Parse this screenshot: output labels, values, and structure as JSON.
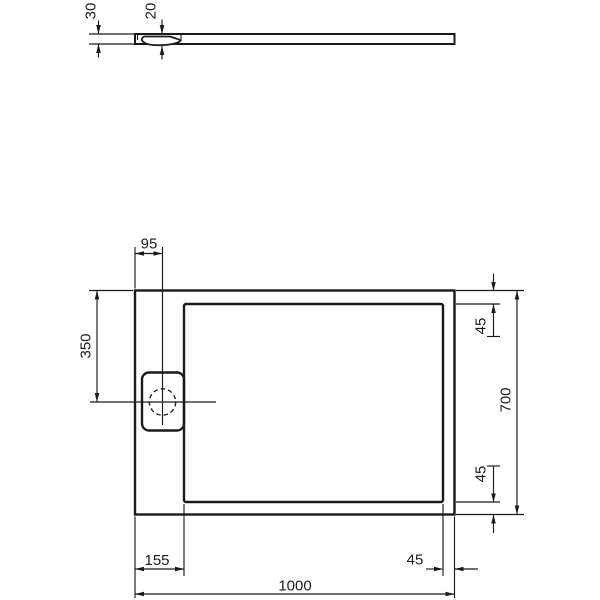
{
  "drawing": {
    "kind": "shower-tray dimension drawing",
    "colors": {
      "line": "#1a1a1a",
      "background": "#ffffff"
    },
    "dims": {
      "profile_height": "30",
      "waste_recess_depth": "20",
      "drain_center_from_left": "95",
      "drain_center_from_top": "350",
      "rim_top": "45",
      "overall_depth": "700",
      "rim_bottom": "45",
      "rim_left": "155",
      "rim_right": "45",
      "overall_width": "1000"
    }
  }
}
